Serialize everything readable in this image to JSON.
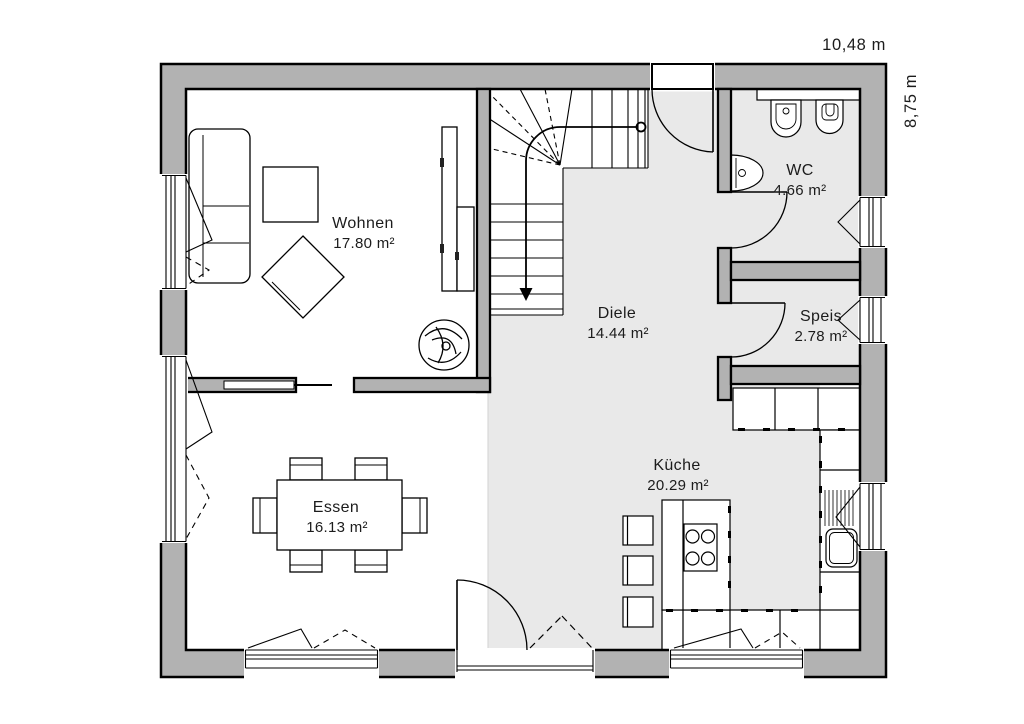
{
  "plan_title": "floor-plan",
  "dims": {
    "width": "10,48 m",
    "height": "8,75 m"
  },
  "rooms": [
    {
      "name": "Wohnen",
      "area": "17.80 m²"
    },
    {
      "name": "Diele",
      "area": "14.44 m²"
    },
    {
      "name": "WC",
      "area": "4.66 m²"
    },
    {
      "name": "Speis",
      "area": "2.78 m²"
    },
    {
      "name": "Küche",
      "area": "20.29 m²"
    },
    {
      "name": "Essen",
      "area": "16.13 m²"
    }
  ],
  "colors": {
    "wall_fill": "#b2b2b2",
    "floor_tint": "#e9e9e9",
    "line": "#000000",
    "text": "#1c1c1c",
    "background": "#ffffff"
  }
}
